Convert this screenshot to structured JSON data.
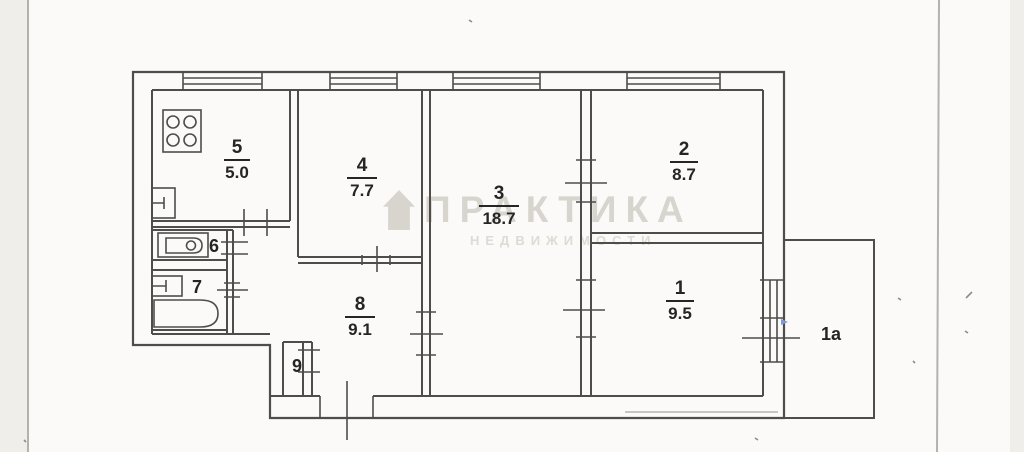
{
  "document": {
    "type": "scanned apartment floor plan (BTI style)"
  },
  "watermark": {
    "logo_icon": "house-icon",
    "line1": "ПРАКТИКА",
    "line2": "НЕДВИЖИМОСТИ"
  },
  "rooms": [
    {
      "key": "kitchen",
      "number": "5",
      "area": "5.0"
    },
    {
      "key": "room4",
      "number": "4",
      "area": "7.7"
    },
    {
      "key": "room3",
      "number": "3",
      "area": "18.7"
    },
    {
      "key": "room2",
      "number": "2",
      "area": "8.7"
    },
    {
      "key": "hall",
      "number": "8",
      "area": "9.1"
    },
    {
      "key": "room1",
      "number": "1",
      "area": "9.5"
    },
    {
      "key": "wc",
      "number": "6"
    },
    {
      "key": "bathroom",
      "number": "7"
    },
    {
      "key": "closet",
      "number": "9"
    },
    {
      "key": "balcony",
      "number": "1а"
    }
  ],
  "icons": {
    "stove-icon": "square with four burner circles",
    "kitchen-sink-icon": "small rectangle with tap",
    "toilet-icon": "rounded cistern shape with circle",
    "bath-sink-icon": "small rectangle with tap",
    "bathtub-icon": "rounded-end rectangle",
    "window-icon": "triple parallel lines in wall",
    "door-icon": "tick lines crossing wall opening",
    "house-icon": "pentagon house silhouette"
  },
  "colors": {
    "line": "#4f4c49",
    "pageLine": "#b5b1ac",
    "bgCenter": "#fbfaf8",
    "bgSide": "#f0eeea",
    "label": "#262523",
    "wm1": "#d8d4ce",
    "wm2": "#dedad4",
    "speck": "#8f8c88",
    "blueMark": "#7b9bd8"
  }
}
